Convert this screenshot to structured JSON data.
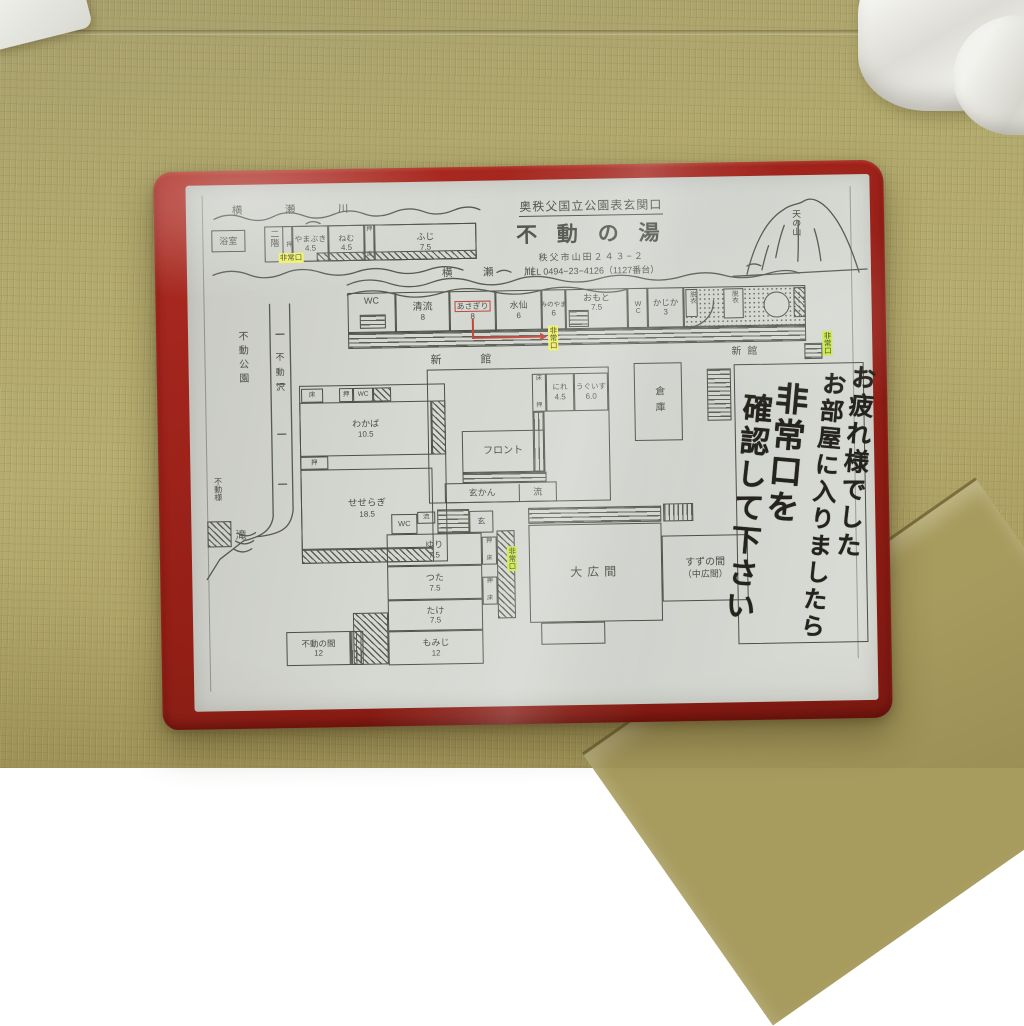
{
  "scene": {
    "folder_color": "#9e241c",
    "paper_color": "#d3d5cf",
    "ink_color": "#4c4f46",
    "highlight_yellow": "#eef163",
    "highlight_green": "#c9e94e",
    "route_red": "#c0453a",
    "tatami_color": "#ada367"
  },
  "header": {
    "region": "奥秩父国立公園表玄関口",
    "name": "不 動 の 湯",
    "address": "秩父市山田２４３−２",
    "tel": "TEL 0494−23−4126（1127番台）"
  },
  "geo": {
    "river_top": "横　瀬　川",
    "river_mid": "横　瀬　川",
    "mountain": "天の山",
    "park": "不動公園",
    "stream": "不動沢",
    "falls": "滝",
    "shrine": "不動様"
  },
  "message": {
    "line1": "お疲れ様でした",
    "line2": "お部屋に入りましたら",
    "line3": "非常口を",
    "line4": "確認して下さい"
  },
  "exits": {
    "label": "非常口"
  },
  "buildings": {
    "shinkan_spaced": "新　館",
    "shinkan": "新館",
    "second_floor": "二階",
    "storage": "倉庫"
  },
  "facilities": {
    "front_desk": "フロント",
    "entrance": "玄かん",
    "entrance_short": "玄",
    "sink": "流",
    "wc": "WC",
    "bath": "浴室",
    "dressing": "脱衣",
    "closet": "押",
    "toko": "床"
  },
  "halls": {
    "large": "大広間",
    "suzu": "すずの間",
    "suzu_sub": "（中広間）",
    "fudo": "不動の間",
    "fudo_size": "12"
  },
  "rooms": {
    "annex": [
      {
        "name": "やまぶき",
        "size": "4.5"
      },
      {
        "name": "ねむ",
        "size": "4.5"
      },
      {
        "name": "ふじ",
        "size": "7.5"
      }
    ],
    "main": [
      {
        "name": "清流",
        "size": "8"
      },
      {
        "name": "あさぎり",
        "size": "8"
      },
      {
        "name": "水仙",
        "size": "6"
      },
      {
        "name": "みのやま",
        "size": "6"
      },
      {
        "name": "おもと",
        "size": "7.5"
      },
      {
        "name": "かじか",
        "size": "3"
      }
    ],
    "mid": [
      {
        "name": "にれ",
        "size": "4.5"
      },
      {
        "name": "うぐいす",
        "size": "6.0"
      }
    ],
    "west": [
      {
        "name": "わかば",
        "size": "10.5"
      },
      {
        "name": "せせらぎ",
        "size": "18.5"
      }
    ],
    "south": [
      {
        "name": "ゆり",
        "size": "7.5"
      },
      {
        "name": "つた",
        "size": "7.5"
      },
      {
        "name": "たけ",
        "size": "7.5"
      },
      {
        "name": "もみじ",
        "size": "12"
      }
    ]
  }
}
